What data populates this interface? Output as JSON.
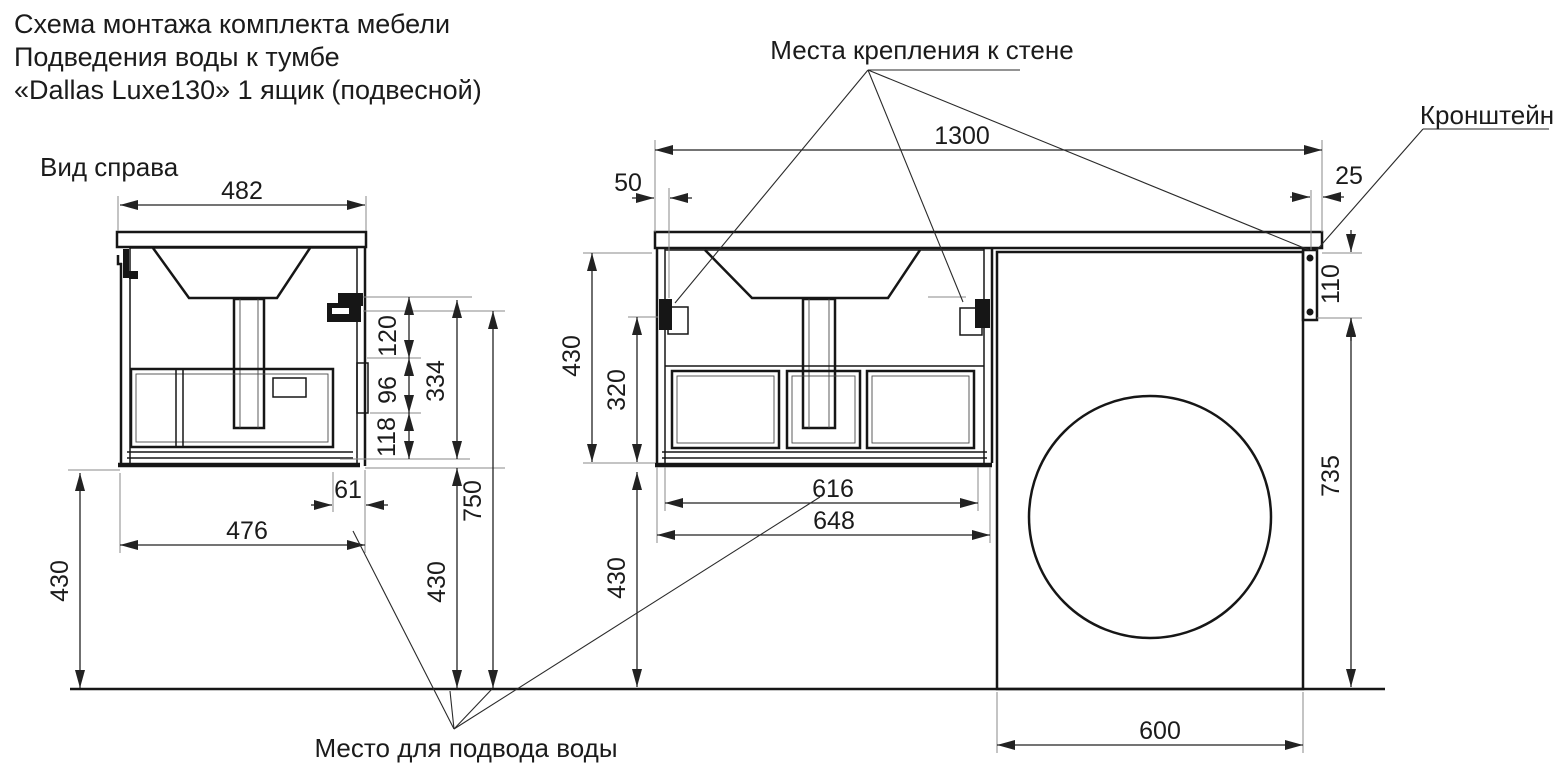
{
  "title": {
    "line1": "Схема монтажа комплекта мебели",
    "line2": "Подведения воды к тумбе",
    "line3": "«Dallas Luxe130» 1 ящик (подвесной)"
  },
  "labels": {
    "side_view": "Вид справа",
    "wall_mounting": "Места крепления к стене",
    "bracket": "Кронштейн",
    "water_supply": "Место для подвода воды"
  },
  "dims": {
    "w482": "482",
    "h120": "120",
    "h96": "96",
    "h118": "118",
    "h334": "334",
    "h750": "750",
    "h430_side_left": "430",
    "h430_side_mid": "430",
    "w61": "61",
    "w476": "476",
    "w1300": "1300",
    "w50": "50",
    "w25": "25",
    "h110": "110",
    "h430_front": "430",
    "h320": "320",
    "h430_front_floor": "430",
    "w616": "616",
    "w648": "648",
    "h735": "735",
    "w600": "600"
  },
  "colors": {
    "background": "#ffffff",
    "line": "#161616",
    "dimension_line": "#222222"
  }
}
